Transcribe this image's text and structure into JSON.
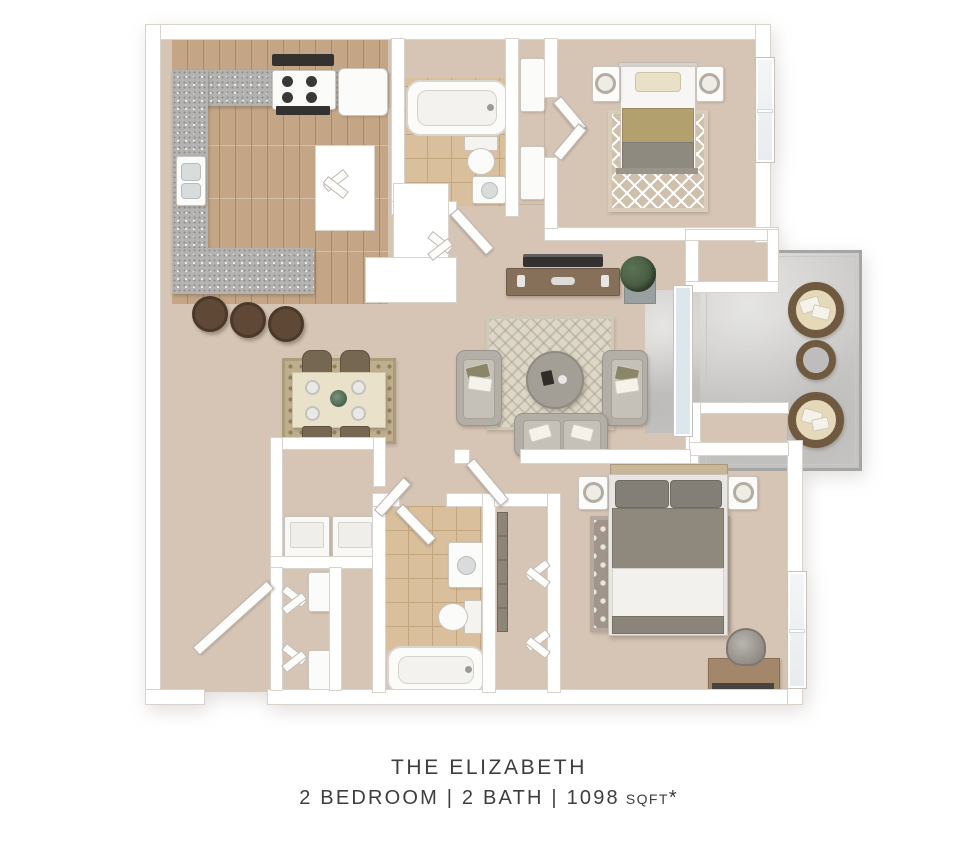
{
  "caption": {
    "title": "THE ELIZABETH",
    "subtitle": {
      "main": "2 BEDROOM | 2 BATH | 1098",
      "unit": "SQFT",
      "footnote": "*"
    }
  },
  "facts": {
    "bedrooms": 2,
    "bathrooms": 2,
    "sqft": 1098
  },
  "colors": {
    "page-bg": "#ffffff",
    "wall": "#ffffff",
    "wall-edge": "#d8d3cb",
    "floor": "#d6c4b4",
    "wood": "#c4a687",
    "wood-line": "#a98a68",
    "tile": "#d9bf9b",
    "tile-line": "#c3a67e",
    "granite": "#b4b3b1",
    "granite-dot": "#8c8c8c",
    "concrete": "#cccbc9",
    "concrete-shade": "#bdbcba",
    "rug-living": "#ddd7c8",
    "rug-bed2": "#cfc0ab",
    "rug-master": "#a1948a",
    "rug-master-dot": "#e9e6e1",
    "rug-dining": "#bfae8d",
    "rug-dining-dot": "#8f7f5a",
    "sofa": "#b3aea6",
    "bed-gray": "#8f897d",
    "bed-gray-dark": "#837e76",
    "bed-white": "#f2f1ee",
    "blanket-tan": "#b2a06e",
    "pillow-cream": "#e9e0c8",
    "wood-dark": "#87705a",
    "wicker": "#6f5a3f",
    "cushion": "#e5d9ba",
    "plant": "#44573f",
    "dark": "#343230",
    "window": "#e8ecef",
    "glass": "#dde6ea",
    "text": "#3e3e41"
  }
}
